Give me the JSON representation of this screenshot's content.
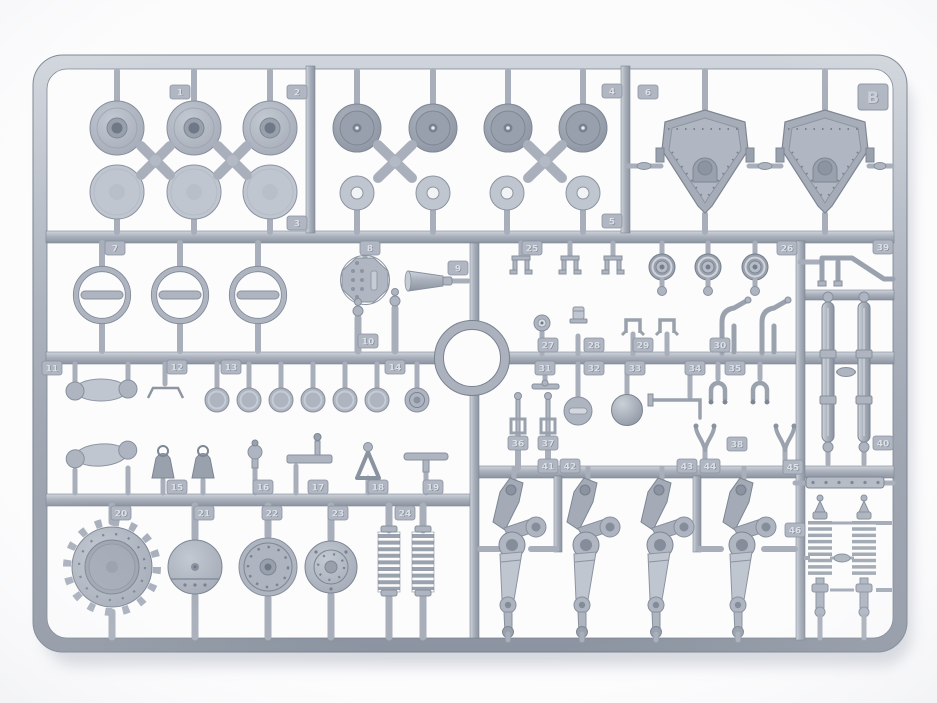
{
  "photo": {
    "sheet_label": "B"
  },
  "colors": {
    "plastic_light": "#c0c6cf",
    "plastic_mid": "#aeb5c0",
    "plastic_dark": "#99a1ad",
    "edge": "#7d8693",
    "background": "#fcfcfd"
  },
  "tags": [
    {
      "n": "1",
      "x": 180,
      "y": 92
    },
    {
      "n": "2",
      "x": 297,
      "y": 92
    },
    {
      "n": "3",
      "x": 297,
      "y": 223
    },
    {
      "n": "4",
      "x": 612,
      "y": 91
    },
    {
      "n": "5",
      "x": 612,
      "y": 221
    },
    {
      "n": "6",
      "x": 648,
      "y": 92
    },
    {
      "n": "7",
      "x": 115,
      "y": 248
    },
    {
      "n": "8",
      "x": 370,
      "y": 248
    },
    {
      "n": "9",
      "x": 458,
      "y": 268
    },
    {
      "n": "10",
      "x": 368,
      "y": 341
    },
    {
      "n": "11",
      "x": 52,
      "y": 368
    },
    {
      "n": "12",
      "x": 177,
      "y": 367
    },
    {
      "n": "13",
      "x": 231,
      "y": 367
    },
    {
      "n": "14",
      "x": 395,
      "y": 367
    },
    {
      "n": "15",
      "x": 177,
      "y": 487
    },
    {
      "n": "16",
      "x": 263,
      "y": 487
    },
    {
      "n": "17",
      "x": 318,
      "y": 487
    },
    {
      "n": "18",
      "x": 378,
      "y": 487
    },
    {
      "n": "19",
      "x": 433,
      "y": 487
    },
    {
      "n": "20",
      "x": 121,
      "y": 513
    },
    {
      "n": "21",
      "x": 204,
      "y": 513
    },
    {
      "n": "22",
      "x": 272,
      "y": 513
    },
    {
      "n": "23",
      "x": 338,
      "y": 513
    },
    {
      "n": "24",
      "x": 405,
      "y": 513
    },
    {
      "n": "25",
      "x": 532,
      "y": 248
    },
    {
      "n": "26",
      "x": 787,
      "y": 248
    },
    {
      "n": "27",
      "x": 548,
      "y": 345
    },
    {
      "n": "28",
      "x": 594,
      "y": 345
    },
    {
      "n": "29",
      "x": 643,
      "y": 345
    },
    {
      "n": "30",
      "x": 720,
      "y": 345
    },
    {
      "n": "31",
      "x": 545,
      "y": 368
    },
    {
      "n": "32",
      "x": 594,
      "y": 368
    },
    {
      "n": "33",
      "x": 635,
      "y": 368
    },
    {
      "n": "34",
      "x": 695,
      "y": 368
    },
    {
      "n": "35",
      "x": 735,
      "y": 368
    },
    {
      "n": "36",
      "x": 518,
      "y": 443
    },
    {
      "n": "37",
      "x": 548,
      "y": 443
    },
    {
      "n": "38",
      "x": 737,
      "y": 444
    },
    {
      "n": "39",
      "x": 883,
      "y": 247
    },
    {
      "n": "40",
      "x": 883,
      "y": 443
    },
    {
      "n": "41",
      "x": 548,
      "y": 466
    },
    {
      "n": "42",
      "x": 570,
      "y": 466
    },
    {
      "n": "43",
      "x": 687,
      "y": 466
    },
    {
      "n": "44",
      "x": 710,
      "y": 466
    },
    {
      "n": "45",
      "x": 793,
      "y": 467
    },
    {
      "n": "46",
      "x": 795,
      "y": 530
    }
  ]
}
